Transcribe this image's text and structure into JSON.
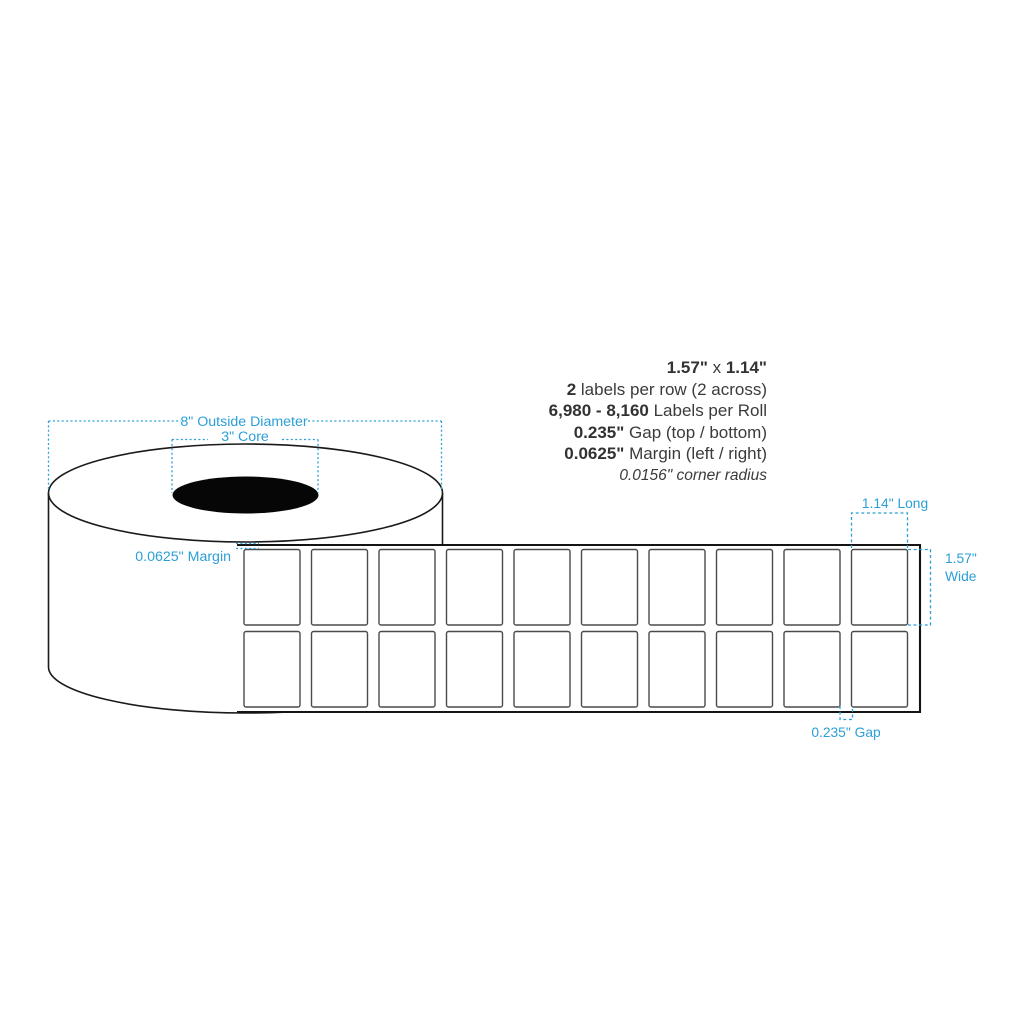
{
  "colors": {
    "annotation_blue": "#2b9fd8",
    "spec_text": "#3b3b3b",
    "outline_black": "#1a1a1a",
    "core_black": "#060606"
  },
  "spec_block": {
    "line1": {
      "bold1": "1.57\"",
      "mid": " x ",
      "bold2": "1.14\""
    },
    "line2": {
      "bold": "2",
      "rest": " labels per row (2 across)"
    },
    "line3": {
      "bold": "6,980 - 8,160",
      "rest": " Labels per Roll"
    },
    "line4": {
      "bold": "0.235\"",
      "rest": " Gap (top / bottom)"
    },
    "line5": {
      "bold": "0.0625\"",
      "rest": " Margin (left / right)"
    },
    "line6": {
      "italic": "0.0156\" corner radius"
    }
  },
  "annotations": {
    "outside_diameter": "8\" Outside Diameter",
    "core": "3\" Core",
    "margin": "0.0625\" Margin",
    "long": "1.14\" Long",
    "wide_line1": "1.57\"",
    "wide_line2": "Wide",
    "gap": "0.235\" Gap"
  },
  "roll": {
    "rows": 2,
    "columns": 10
  }
}
